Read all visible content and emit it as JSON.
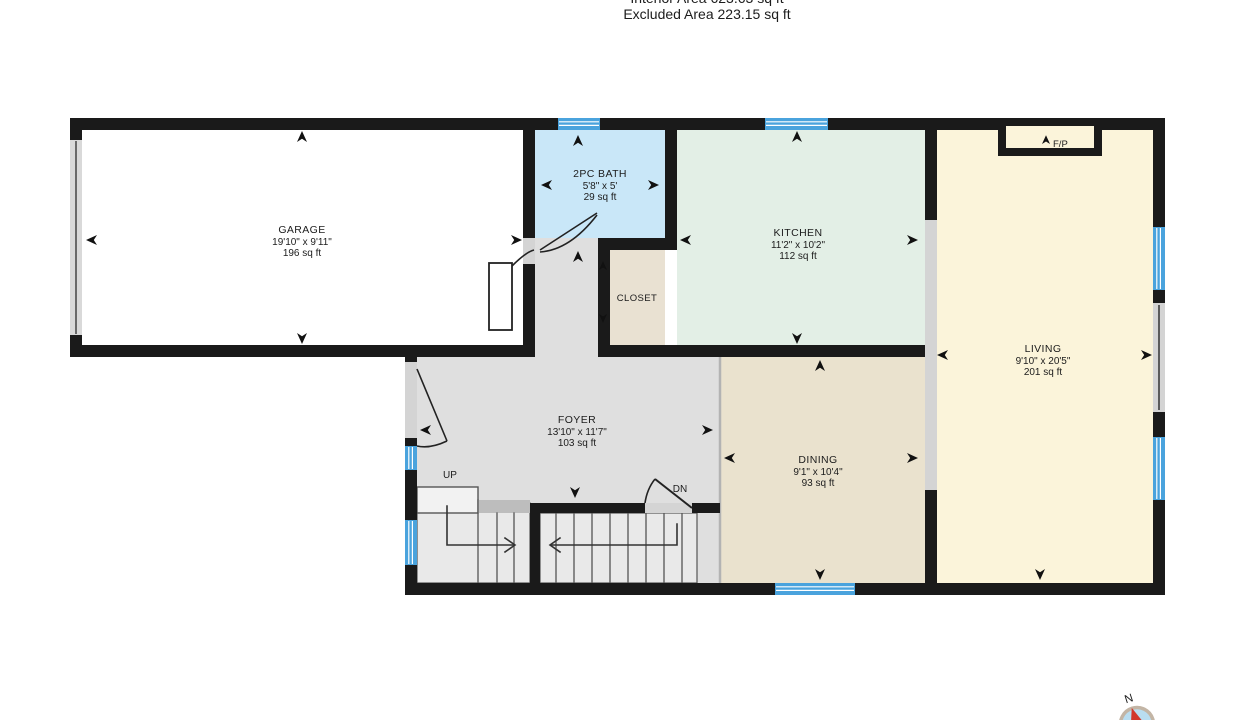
{
  "header": {
    "interior_area": "Interior Area 623.63 sq ft",
    "excluded_area": "Excluded Area 223.15 sq ft"
  },
  "rooms": {
    "garage": {
      "name": "GARAGE",
      "dims": "19'10\" x 9'11\"",
      "area": "196 sq ft"
    },
    "bath": {
      "name": "2PC BATH",
      "dims": "5'8\" x 5'",
      "area": "29 sq ft"
    },
    "kitchen": {
      "name": "KITCHEN",
      "dims": "11'2\" x 10'2\"",
      "area": "112 sq ft"
    },
    "living": {
      "name": "LIVING",
      "dims": "9'10\" x 20'5\"",
      "area": "201 sq ft"
    },
    "dining": {
      "name": "DINING",
      "dims": "9'1\" x 10'4\"",
      "area": "93 sq ft"
    },
    "foyer": {
      "name": "FOYER",
      "dims": "13'10\" x 11'7\"",
      "area": "103 sq ft"
    },
    "closet": {
      "name": "CLOSET"
    }
  },
  "labels": {
    "fireplace": "F/P",
    "stairs_up": "UP",
    "stairs_down": "DN",
    "compass_north": "N"
  },
  "colors": {
    "wall": "#1a1a1a",
    "window": "#4aa3dd",
    "opening": "#d4d4d4",
    "garage": "#ffffff",
    "bath": "#c9e7f8",
    "kitchen": "#e3efe6",
    "living": "#fbf4da",
    "dining": "#eae2ce",
    "closet": "#e9e1d2",
    "foyer": "#dfdfdf",
    "stairs": "#e9e9e9",
    "compass_needle": "#d2372c"
  }
}
